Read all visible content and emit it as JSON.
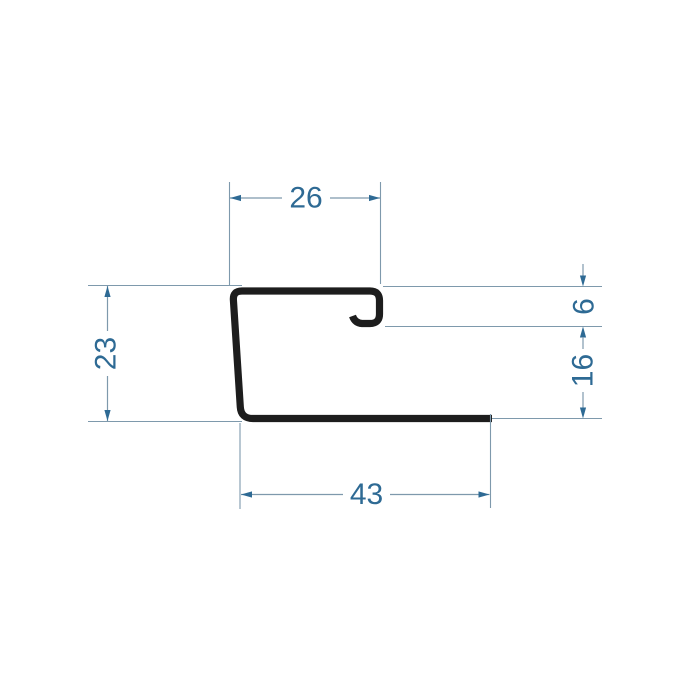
{
  "drawing": {
    "colors": {
      "profile": "#1d1d1d",
      "line": "#7e99ac",
      "accent": "#2e6a94",
      "background": "#ffffff"
    },
    "dimensions": [
      {
        "id": "top-width",
        "value": "26",
        "orientation": "horizontal"
      },
      {
        "id": "left-height",
        "value": "23",
        "orientation": "vertical"
      },
      {
        "id": "hook-height",
        "value": "6",
        "orientation": "vertical"
      },
      {
        "id": "right-lower-height",
        "value": "16",
        "orientation": "vertical"
      },
      {
        "id": "bottom-width",
        "value": "43",
        "orientation": "horizontal"
      }
    ]
  }
}
